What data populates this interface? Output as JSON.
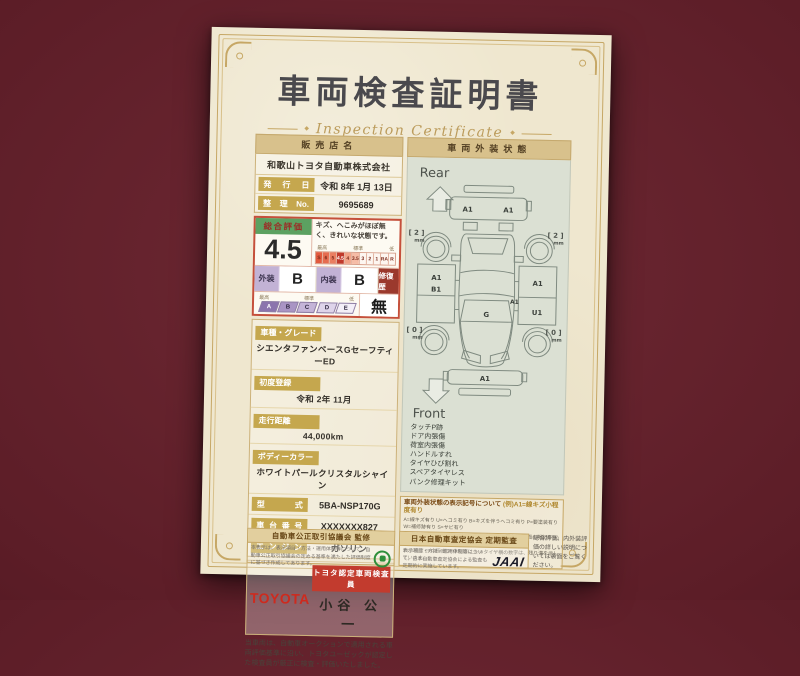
{
  "colors": {
    "background_maroon": "#5c1d27",
    "paper_cream": "#efe7cf",
    "gold_accent": "#c6a765",
    "toyota_red": "#ce2a1e",
    "rating_border_red": "#c5503b",
    "rating_header_green": "#5ca161",
    "grade_purple": "#8b74ad",
    "certification_green": "#2e8f3a"
  },
  "page_title": "車両検査証明書",
  "page_subtitle": "Inspection Certificate",
  "seller": {
    "header": "販売店名",
    "name": "和歌山トヨタ自動車株式会社",
    "issue_label": "発行日",
    "issue_value": "令和 8年 1月 13日",
    "ref_label": "整理No.",
    "ref_value": "9695689"
  },
  "rating": {
    "header": "総合評価",
    "score": "4.5",
    "comment": "キズ、へこみがほぼ無く、きれいな状態です。",
    "scale_high": "最高",
    "scale_mid": "標準",
    "scale_low": "低",
    "scale": [
      "S",
      "6",
      "5",
      "4.5",
      "4",
      "3.5",
      "3",
      "2",
      "1",
      "RA",
      "R"
    ],
    "exterior_label": "外装",
    "exterior_grade": "B",
    "interior_label": "内装",
    "interior_grade": "B",
    "repair_label": "修復歴",
    "repair_value": "無",
    "grades": [
      "A",
      "B",
      "C",
      "D",
      "E"
    ]
  },
  "details": [
    {
      "label": "車種・グレード",
      "value": "シエンタファンベースGセーフティーED"
    },
    {
      "label": "初度登録",
      "value": "令和 2年 11月"
    },
    {
      "label": "走行距離",
      "value": "44,000km"
    },
    {
      "label": "ボディーカラー",
      "value": "ホワイトパールクリスタルシャイン"
    },
    {
      "label": "型式",
      "value": "5BA-NSP170G"
    },
    {
      "label": "車台番号",
      "value": "XXXXXXX827"
    },
    {
      "label": "エンジン",
      "value": "ガソリン"
    }
  ],
  "inspector": {
    "brand": "TOYOTA",
    "role": "トヨタ認定車両検査員",
    "name": "小谷 公一"
  },
  "disclaimer": "当車両は、自動車オークションで適用される車両評価基準に沿い、トヨタユーゼックが認定した検査員が厳正に検査・評価いたしました。",
  "exterior": {
    "header": "車両外装状態",
    "rear": "Rear",
    "front": "Front",
    "marks": {
      "rear_bumper_left": "A1",
      "rear_bumper_right": "A1",
      "left_side_a": "A1",
      "left_side_b": "B1",
      "right_side_upper": "A1",
      "center_right": "A1",
      "right_side_lower": "U1",
      "windshield": "G",
      "front_bumper": "A1"
    },
    "tires": {
      "rear_left": "[ 2 ]",
      "rear_right": "[ 2 ]",
      "front_left": "[ 0 ]",
      "front_right": "[ 0 ]",
      "unit": "mm"
    },
    "notes": [
      "タッチP跡",
      "ドア内張傷",
      "荷室内張傷",
      "ハンドルすれ",
      "タイヤひび割れ",
      "スペアタイヤレス",
      "パンク修理キット"
    ]
  },
  "legend": {
    "title": "車両外装状態の表示記号について",
    "example": "(例)A1=線キズ小程度有り",
    "lines": [
      "A=線キズ有り U=ヘコミ有り B=キズを伴うヘコミ有り P=要塗装有り W=補修跡有り S=サビ有り",
      "C=腐食有り G=フロントガラス点キズ有り X=要交換(裏面に明記有り) XX=交換跡有り",
      "1=小程度 2=中程度 3=中程度以上 ※タイヤ横の数字は、残り溝を示しています。"
    ]
  },
  "footer": {
    "fair_trade": {
      "title": "自動車公正取引協議会 監修",
      "body": "本表示は、表示項目・方法・運用体制等について、自動車公正取引協議会の定める基準を満たした評価制度に基づき作成してあります。"
    },
    "jaai": {
      "title": "日本自動車査定協会 定期監査",
      "body": "表示項目・方法・運用体制等について、日本自動車査定協会による監査も定期的に実施しています。",
      "logo": "JAAI"
    },
    "back_note": "総合評価、内外装評価の詳しい説明については裏面をご覧ください。"
  }
}
